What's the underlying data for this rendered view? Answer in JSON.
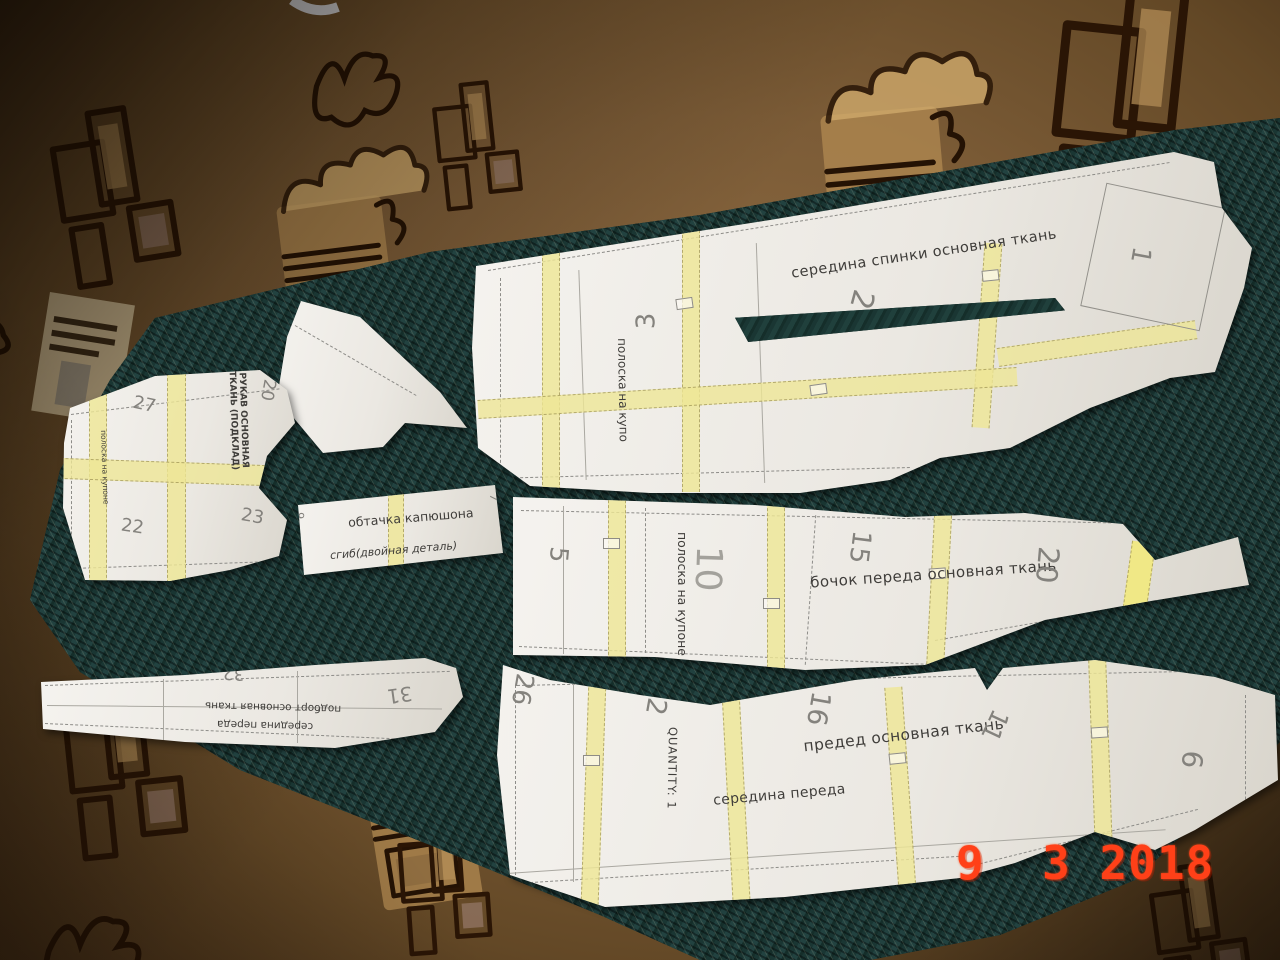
{
  "photo": {
    "description": "Sewing pattern paper pieces laid out on dark teal fabric over a patterned brown carpet",
    "date_stamp": "9  3 2018",
    "colors": {
      "carpet": "#7c5c37",
      "fabric": "#1b2e2c",
      "paper": "#eeebe5",
      "tape": "#ede595",
      "date_stamp": "#ff4018",
      "ink": "#3f3d3a"
    }
  },
  "pieces": {
    "back_center": {
      "name": "середина спинки основная ткань",
      "strip_label": "полоска на купо",
      "num_1": "1",
      "num_2": "2",
      "num_3": "3"
    },
    "sleeve": {
      "name": "РУКАВ ОСНОВНАЯ ТКАНЬ (ПОДКЛАД)",
      "strip_label": "полоска на купоне",
      "num_20": "20",
      "num_22": "22",
      "num_23": "23",
      "num_27": "27"
    },
    "hood_facing": {
      "name": "обтачка капюшона",
      "fold_label": "сгиб(двойная деталь)",
      "num_7": "7",
      "num_9": "9"
    },
    "front_side": {
      "name": "бочок переда основная ткань",
      "strip_label": "полоска на купоне",
      "num_5": "5",
      "num_10": "10",
      "num_15": "15",
      "num_20": "20"
    },
    "front_facing": {
      "name": "подборт основная ткань",
      "center_label": "середина переда",
      "num_31": "31",
      "num_32": "32"
    },
    "front_center": {
      "name": "предед основная ткань",
      "center_label": "середина переда",
      "quantity": "QUANTITY: 1",
      "num_2": "2",
      "num_6": "6",
      "num_11": "11",
      "num_16": "16",
      "num_26": "26"
    }
  }
}
